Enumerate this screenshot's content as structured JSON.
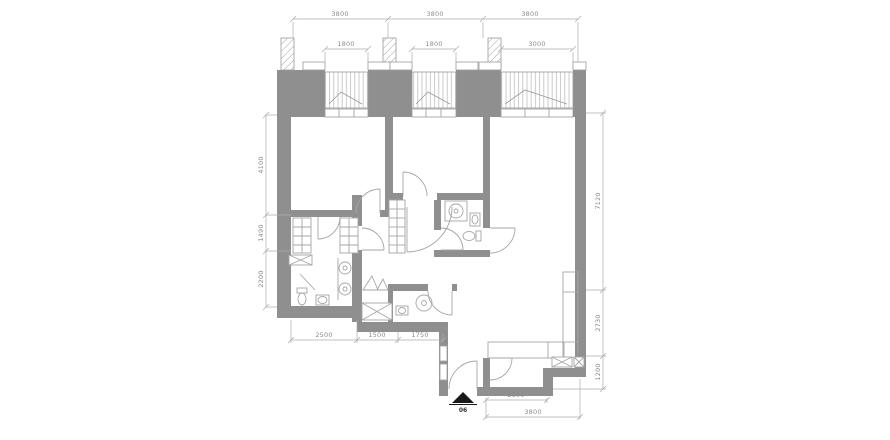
{
  "plan": {
    "entry_label": "06",
    "dims": {
      "top": [
        "3800",
        "3800",
        "3800"
      ],
      "windows": [
        "1800",
        "1800",
        "3000"
      ],
      "left": [
        "4100",
        "1490",
        "2200"
      ],
      "right": [
        "7120",
        "2730",
        "1200"
      ],
      "bottom": [
        "2500",
        "1500",
        "1750"
      ],
      "entry": [
        "2500",
        "3800"
      ]
    },
    "colors": {
      "wall": "#8f8f8f",
      "fixture": "#a6a6a6",
      "dim_line": "#ababab",
      "dim_text": "#8c8c8c",
      "window_frame": "#9a9a9a",
      "entry_marker": "#1a1a1a"
    }
  }
}
